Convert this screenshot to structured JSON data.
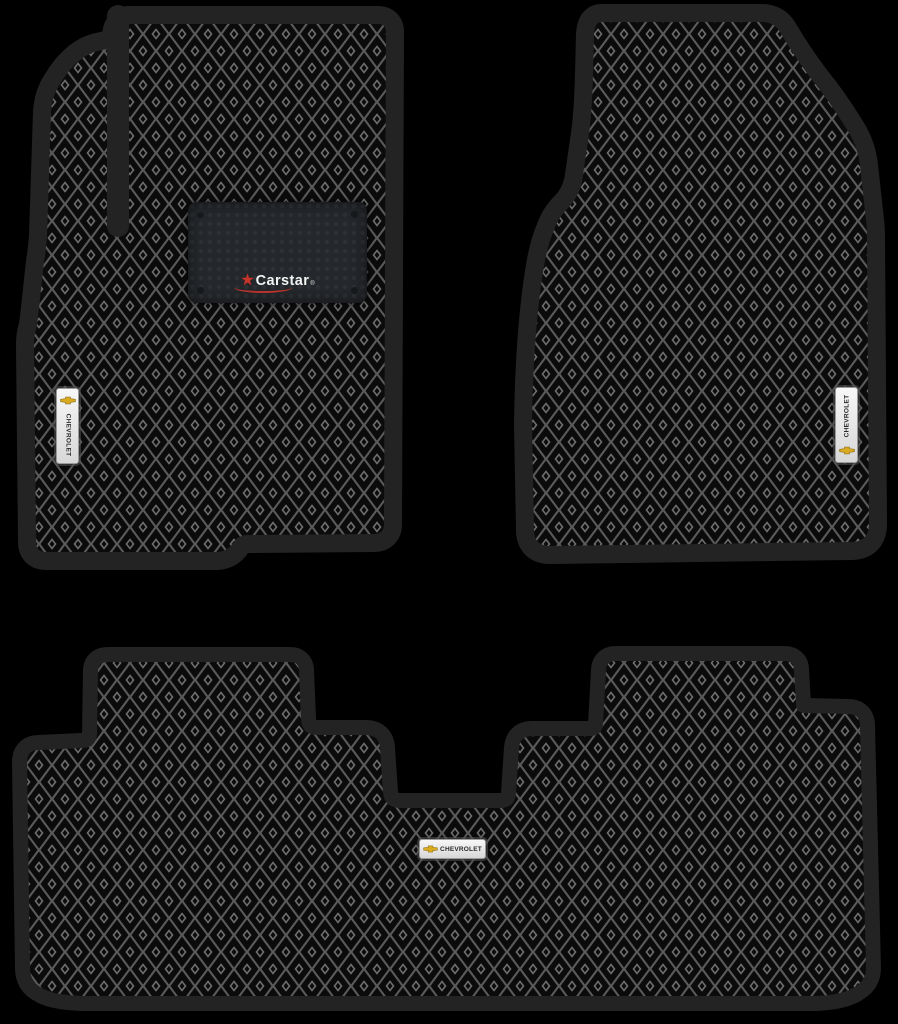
{
  "product": {
    "name": "EVA car floor mats set (3 pieces)",
    "pieces": [
      "front-left-mat",
      "front-right-mat",
      "rear-mat"
    ]
  },
  "brand_patch": {
    "brand": "Carstar",
    "registered": "®",
    "star_icon": "red-star-icon"
  },
  "badges": {
    "front_left": "CHEVROLET",
    "front_right": "CHEVROLET",
    "rear": "CHEVROLET"
  },
  "colors": {
    "background": "#000000",
    "mat_border": "#232323",
    "pattern_base": "#0b0b0b",
    "pattern_lattice": "#5a5a5a",
    "pattern_dot_ring": "#6e6e6e",
    "patch_background": "#24272b",
    "patch_text": "#f2f2f2",
    "patch_star_red": "#c6352c",
    "badge_background": "#ececec",
    "badge_text": "#2a2a2a",
    "bowtie_gold": "#d9a920"
  }
}
